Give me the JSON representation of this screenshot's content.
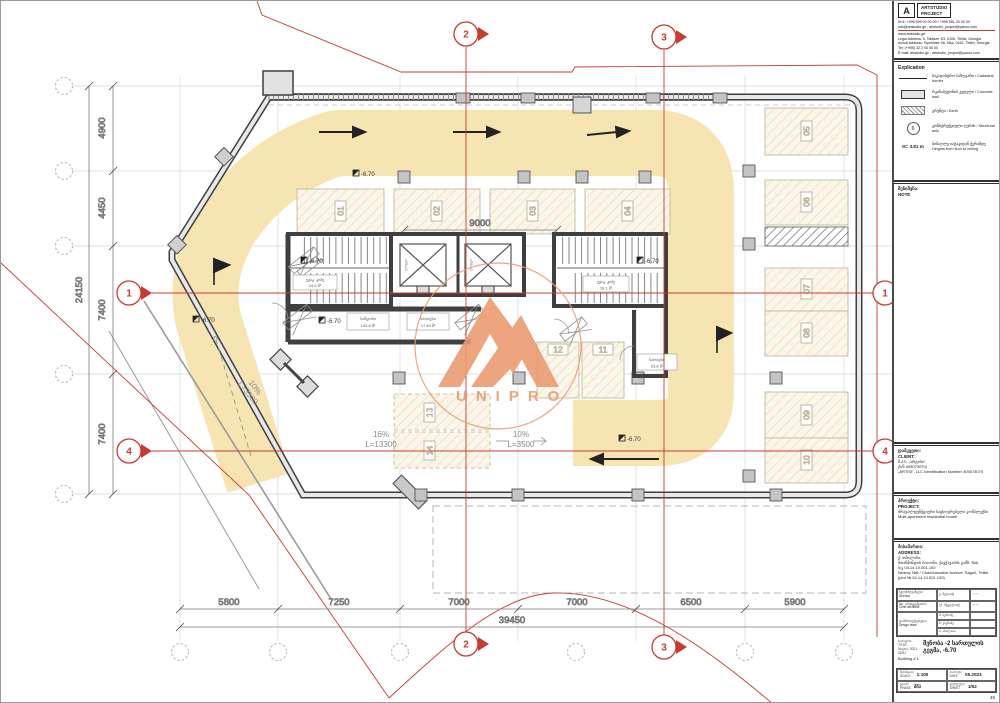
{
  "watermark": {
    "name": "UNIPRO",
    "color": "#ea9c72"
  },
  "plan": {
    "dims": {
      "left": [
        "4900",
        "4450",
        "7400",
        "7400"
      ],
      "left_total": "24150",
      "bottom": [
        "5800",
        "7250",
        "7000",
        "7000",
        "6500",
        "5900"
      ],
      "bottom_total": "39450",
      "top_inner": "9000"
    },
    "axes": {
      "h1": "1",
      "h4": "4",
      "v2": "2",
      "v3": "3"
    },
    "stalls": [
      "01",
      "02",
      "03",
      "04",
      "05",
      "06",
      "07",
      "08",
      "09",
      "10",
      "11",
      "12",
      "13",
      "14"
    ],
    "ramp_main": {
      "grade": "16%",
      "len": "L=13300"
    },
    "ramp_center": {
      "grade": "10%",
      "len": "L=3500"
    },
    "ramp_diag": {
      "grade": "10%",
      "len": "L=3500"
    },
    "level": "-6.70",
    "rooms": [
      {
        "n": "ევაკ. კიბე",
        "a": "24.6 მ²"
      },
      {
        "n": "საწყობი",
        "a": "142.8 მ²"
      },
      {
        "n": "სათავსი",
        "a": "17.45 მ²"
      },
      {
        "n": "ევაკ. კიბე",
        "a": "19.1 მ²"
      },
      {
        "n": "სათავსი",
        "a": "23.8 მ²"
      }
    ],
    "elevator_label": "ლიფტი"
  },
  "titleblock": {
    "logo": {
      "letter": "A",
      "firm1": "ARTSTUDIO",
      "firm2": "PROJECT"
    },
    "contacts": [
      "მობ: +995 599 00 00 00  /  +995 591 00 00 00",
      "info@artstudio.ge ; artstudio_project@yahoo.com",
      "www.artstudio.ge",
      "Legal Address: 5, Tabidze 1/3, 0105, Tbilisi, Georgia",
      "Actual Address: Kipshidze Str. N4a, 0162, Tbilisi, Georgia",
      "Tel: (+995) 32 2 00 00 00",
      "E-mail: artstudio.ge ; artstudio_project@yahoo.com"
    ],
    "explication_label": "Explication",
    "legend": [
      {
        "ka": "საკადასტრო საზღვარი",
        "en": "/ Cadastral border"
      },
      {
        "ka": "რკინაბეტონის კედელი",
        "en": "/ Concrete wall"
      },
      {
        "ka": "გრუნტი",
        "en": "/ Earth"
      },
      {
        "ka": "კონსტრუქციული ღერძი",
        "en": "/ Structural axis",
        "axis_num": "6"
      },
      {
        "val": "H= 3.81 m",
        "ka": "სიმაღლე იატაკიდან ჭერამდე",
        "en": "Heights from floor to ceiling"
      }
    ],
    "note": {
      "ka": "შენიშვნა:",
      "en": "NOTE"
    },
    "client": {
      "ka": "დამკვეთი:",
      "en": "CLIENT:",
      "lines": [
        "შ.პ.ს. „არტისი“,",
        "(ს/ნ 405073070)",
        "„ARTISI“, LLC Identification Number 405073070"
      ]
    },
    "project": {
      "ka": "პროექტი:",
      "en": "PROJECT:",
      "lines": [
        "მრავალფუნქციური საცხოვრებელი კომპლექსი",
        "Multi-apartment residential house"
      ]
    },
    "address": {
      "ka": "მისამართი:",
      "en": "ADDRESS:",
      "lines": [
        "ქ. თბილისი,",
        "მთაწმინდის რაიონი, ჭავჭავაძის გამზ. №6,",
        "ს/კ 04.14.10.001.100",
        "Nearby №6 / Chavchavadze avenue, Saguli, Tbilisi",
        "(plot № 04.14.10.001.100)"
      ]
    },
    "signatures": {
      "roles": [
        {
          "ka": "ხელმძღვანელი",
          "en": "Director"
        },
        {
          "ka": "მთ. არქიტექტორი",
          "en": "Chief architect"
        },
        {
          "ka": "დამპროექტებელი",
          "en": "Design team"
        }
      ],
      "names": [
        "გ. წულაძე",
        "ლ. მჭედლიძე",
        "მ. ბერიძე",
        "ნ. კიკნაძე",
        "ბ. ახალაია"
      ],
      "scribble": "〜〜"
    },
    "title": {
      "ka": "სათაური:",
      "en": "TITLE:",
      "code": "შიფრი: 2021-02/41",
      "main": "შენობა -2 სართულის გეგმა, -6.70",
      "sub_en": "Building # 1"
    },
    "meta": {
      "scale": {
        "ka": "მასშტაბი",
        "en": "SCALE",
        "val": "1:100"
      },
      "date": {
        "ka": "თარიღი",
        "en": "DATE",
        "val": "05.2023"
      },
      "phase": {
        "ka": "ეტაპი",
        "en": "PHASE",
        "val": "მშპ"
      },
      "sheet": {
        "ka": "ფურცელი",
        "en": "SHEET",
        "val": "1/52"
      },
      "page": "45"
    }
  }
}
